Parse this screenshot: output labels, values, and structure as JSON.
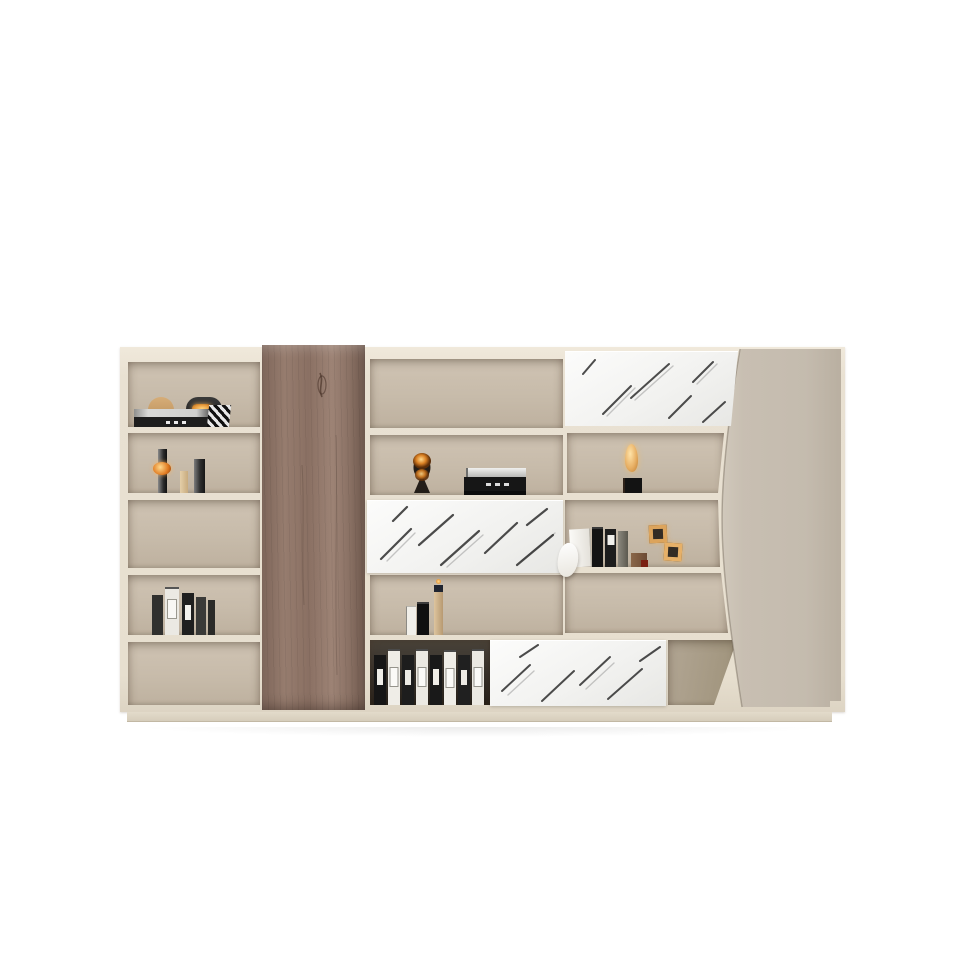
{
  "scene": {
    "type": "product-photo",
    "subject": "modern-office-wall-bookcase-filing-cabinet",
    "background_color": "#ffffff",
    "materials": [
      "cream-lacquer-frame",
      "taupe-interior",
      "walnut-pillar",
      "white-marble-doors",
      "greige-curved-door"
    ]
  },
  "palette": {
    "frame_cream": "#e9e1d2",
    "interior_taupe": "#c7bbaa",
    "interior_dark": "#332d26",
    "wood_brown": "#8a7063",
    "wood_dark": "#5f4b41",
    "marble_white": "#f2f2f0",
    "marble_vein_dark": "#2e2e2e",
    "marble_vein_light": "#9c9c9c",
    "right_panel_greige": "#c6bdb0",
    "right_panel_shade": "#b7ad9e",
    "plinth": "#dcd3c2",
    "accent_amber": "#e3a95c",
    "accent_glow": "#ffd27a",
    "binder_dark": "#1c1c1c",
    "binder_white": "#efede7",
    "book_tan": "#cdb28c"
  },
  "cabinet": {
    "left_column": {
      "compartments": [
        {
          "name": "shelf-top-decor",
          "items": [
            "arch-ornament",
            "arc-lamp-ornament",
            "stacked-books",
            "striped-bookend"
          ]
        },
        {
          "name": "shelf-candle-holders",
          "items": [
            "candle-holder-with-amber-orb",
            "candle-short",
            "candle-tall"
          ]
        },
        {
          "name": "shelf-empty-upper",
          "items": []
        },
        {
          "name": "shelf-binder-cluster",
          "items": [
            "binder-dark",
            "binder-white",
            "binder-dark",
            "binder-dark",
            "binder-dark"
          ]
        },
        {
          "name": "shelf-empty-lower",
          "items": []
        }
      ]
    },
    "wood_pillar": {
      "name": "walnut-vertical-panel",
      "full_height": true
    },
    "center_column": {
      "compartments": [
        {
          "name": "shelf-empty-top",
          "items": []
        },
        {
          "name": "shelf-sculpture",
          "items": [
            "abstract-amber-sculpture",
            "box-stack"
          ]
        },
        {
          "name": "marble-door-center",
          "items": []
        },
        {
          "name": "shelf-small-books",
          "items": [
            "book-white",
            "book-black",
            "tall-bottle-ornament"
          ]
        },
        {
          "name": "shelf-binder-row",
          "items": [
            "binder-dark",
            "binder-white",
            "binder-dark",
            "binder-white",
            "binder-dark",
            "binder-white",
            "binder-dark",
            "binder-white"
          ]
        }
      ]
    },
    "right_column": {
      "compartments": [
        {
          "name": "marble-door-top",
          "items": []
        },
        {
          "name": "shelf-glow-ornament",
          "items": [
            "black-cube-base",
            "amber-leaf-ornament"
          ]
        },
        {
          "name": "shelf-files-and-frames",
          "items": [
            "magazine-file-with-drape",
            "binder-dark",
            "binder-dark",
            "binder-grey",
            "wooden-box",
            "amber-cube-frame",
            "amber-cube-frame"
          ]
        },
        {
          "name": "shelf-empty-wide",
          "items": []
        },
        {
          "name": "shelf-corner-trapezoid",
          "items": []
        }
      ]
    },
    "bottom_row": {
      "marble_door": "marble-door-bottom"
    },
    "curved_door": {
      "name": "greige-curved-side-door",
      "edge": "concave-left-curve"
    },
    "base": {
      "name": "plinth-base"
    }
  }
}
